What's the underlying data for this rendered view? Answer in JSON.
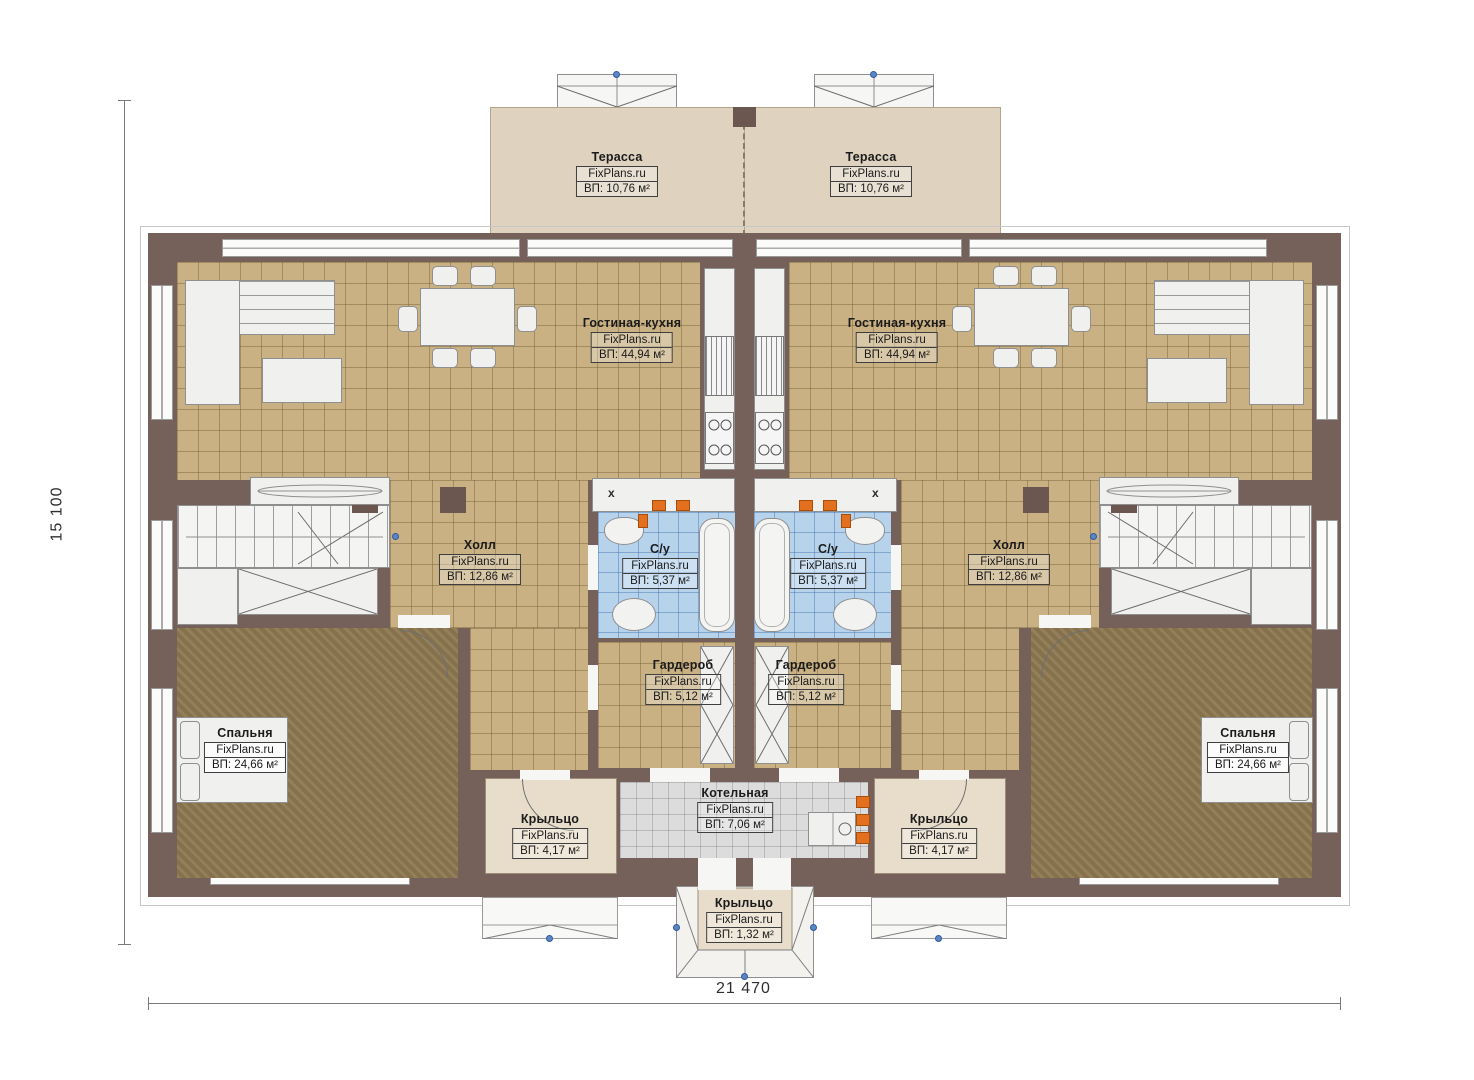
{
  "watermark": "FixPlans.ru",
  "dimensions": {
    "height_label": "15 100",
    "width_label": "21 470"
  },
  "rooms": {
    "terrace_left": {
      "name": "Терасса",
      "watermark": "FixPlans.ru",
      "area": "ВП: 10,76 м²"
    },
    "terrace_right": {
      "name": "Терасса",
      "watermark": "FixPlans.ru",
      "area": "ВП: 10,76 м²"
    },
    "living_left": {
      "name": "Гостиная-кухня",
      "watermark": "FixPlans.ru",
      "area": "ВП: 44,94 м²"
    },
    "living_right": {
      "name": "Гостиная-кухня",
      "watermark": "FixPlans.ru",
      "area": "ВП: 44,94 м²"
    },
    "hall_left": {
      "name": "Холл",
      "watermark": "FixPlans.ru",
      "area": "ВП: 12,86 м²"
    },
    "hall_right": {
      "name": "Холл",
      "watermark": "FixPlans.ru",
      "area": "ВП: 12,86 м²"
    },
    "bath_left": {
      "name": "С/у",
      "watermark": "FixPlans.ru",
      "area": "ВП: 5,37 м²"
    },
    "bath_right": {
      "name": "С/у",
      "watermark": "FixPlans.ru",
      "area": "ВП: 5,37 м²"
    },
    "wardrobe_left": {
      "name": "Гардероб",
      "watermark": "FixPlans.ru",
      "area": "ВП: 5,12 м²"
    },
    "wardrobe_right": {
      "name": "Гардероб",
      "watermark": "FixPlans.ru",
      "area": "ВП: 5,12 м²"
    },
    "bedroom_left": {
      "name": "Спальня",
      "watermark": "FixPlans.ru",
      "area": "ВП: 24,66 м²"
    },
    "bedroom_right": {
      "name": "Спальня",
      "watermark": "FixPlans.ru",
      "area": "ВП: 24,66 м²"
    },
    "boiler": {
      "name": "Котельная",
      "watermark": "FixPlans.ru",
      "area": "ВП: 7,06 м²"
    },
    "porch_left": {
      "name": "Крыльцо",
      "watermark": "FixPlans.ru",
      "area": "ВП: 4,17 м²"
    },
    "porch_right": {
      "name": "Крыльцо",
      "watermark": "FixPlans.ru",
      "area": "ВП: 4,17 м²"
    },
    "porch_center": {
      "name": "Крыльцо",
      "watermark": "FixPlans.ru",
      "area": "ВП: 1,32 м²"
    }
  },
  "misc": {
    "x_mark": "x"
  },
  "colors": {
    "wall": "#75615A",
    "tile_tan": "#C9B183",
    "bedroom_floor": "#8E7852",
    "bath_tile": "#B7D3EC",
    "terrace": "#DFD3C0",
    "porch": "#E8DDCB",
    "boiler_tile": "#DCDCDC",
    "radiator_orange": "#E2701F",
    "marker_blue": "#5B86C5"
  }
}
